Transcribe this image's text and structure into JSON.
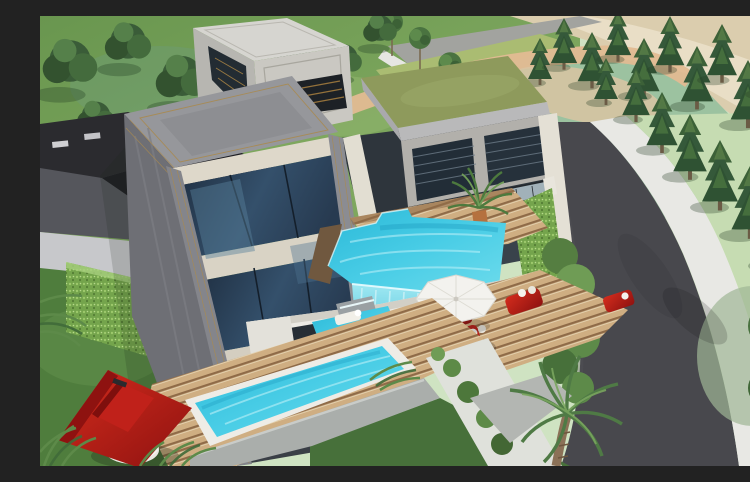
{
  "scene": {
    "type": "architectural-3d-render",
    "description": "Aerial 3D architectural rendering of a modern multi-storey villa: grey concrete tower with three floors of dark glass, white marble entry tower, stone wing with green planted flat roof, turquoise infinity pool with glass waterfall edge, kids pool with in-pool white loungers, long lap pool with white rim, striped wooden sun decks, white parasol, red sun loungers and sofas, round wicker daybed, potted palm, red-roofed garden gazebo with round white table, vertical garden walls, cypress tree rows, palm trees, curved dark asphalt road with white sidewalk, lawns and sandy ground.",
    "time_of_day": "day",
    "style": "photorealistic render"
  },
  "palette": {
    "pool_water": "#35c5e0",
    "pool_water_light": "#7fe0ef",
    "glass_waterfall": "#8fe0ef",
    "asphalt_road": "#48484d",
    "sidewalk": "#e8e8e4",
    "lawn_dark": "#4f7d3d",
    "lawn_light": "#8fb46c",
    "grass_teal": "#9cc2a0",
    "grass_right": "#c6dcb2",
    "sand": "#dbcdae",
    "path_pink": "#e2ba92",
    "concrete_grey": "#8c8d92",
    "concrete_dark": "#6e6f75",
    "marble_cream": "#ded8ca",
    "window_glass": "#223447",
    "gold_trim": "#a98a50",
    "green_roof": "#8e9a5c",
    "living_wall": "#7cab53",
    "deck_wood": "#caa87d",
    "deck_stripe": "#8f6b48",
    "red_furniture": "#b8201a",
    "gazebo_red": "#b01311",
    "cypress_green": "#2f5233",
    "palm_green": "#5d8a49",
    "white_structure": "#eceae4",
    "neighbor_roof": "#2b2b2f"
  },
  "objects": {
    "main_tower": "three-storey grey concrete tower with gold trim and dark blue glass curtain walls",
    "entry_tower": "white marble entry tower with recessed trim and dark glazed slot",
    "right_wing": "two-storey stone wing with louvred dark windows, glass balustrade and green planted roof",
    "infinity_pool": "turquoise infinity pool with transparent glass waterfall edge",
    "kids_pool": "small pool with two white in-pool loungers and stone water feature",
    "lap_pool": "long white-rimmed turquoise lap pool on striped wooden deck",
    "pool_bar": "white cabana / pool bar structure with dark opening",
    "parasol": "white octagonal sun umbrella",
    "red_loungers": "pair of red sun loungers with white pillows",
    "red_sofas": "two red outdoor sofas with white cushions",
    "daybed": "round wicker daybed with white cushion",
    "potted_palm": "potted palm in terracotta pot on terrace",
    "gazebo": "red pyramidal-roof garden gazebo with round white table",
    "living_walls": "vertical garden green walls",
    "hedge_wall": "ivy-covered garden wall at lower left",
    "neighbor_house": "dark flat-roofed neighbouring building at left",
    "road": "curved dark asphalt road with white sidewalk and lawns",
    "trees": "rows of cypress trees, deciduous trees, saplings and palms",
    "retaining_walls": "grey concrete retaining walls with creeping plants and gravel path"
  }
}
